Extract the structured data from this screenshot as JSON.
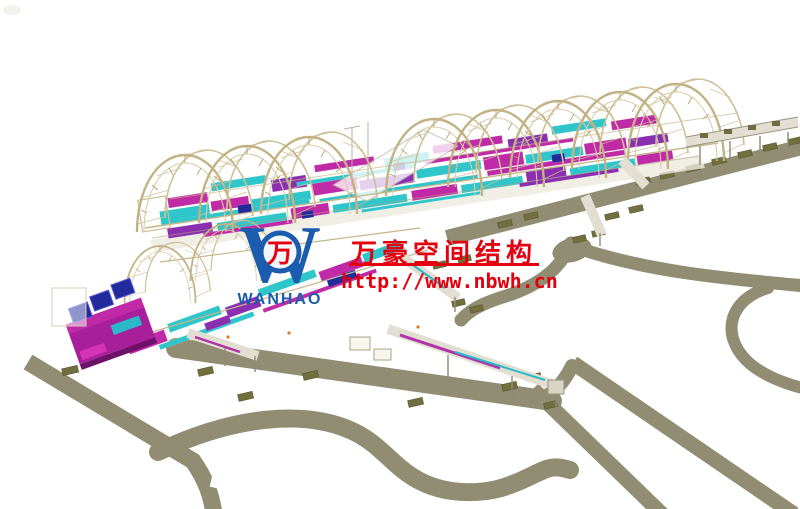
{
  "page": {
    "alt_text": "3D structural BIM model render of an airport terminal concourse with arched steel roof trusses, colored MEP duct systems, jet-bridge walkways, aprons and curving access roads, overlaid with a company watermark"
  },
  "watermark": {
    "company_name_cn": "万豪空间结构",
    "website_url": "http://www.nbwh.cn",
    "text_color": "#e3000f",
    "logo": {
      "word": "WANHAO",
      "glyph": "万",
      "blue": "#1b5caf",
      "glyph_color": "#e3000f"
    }
  },
  "palette": {
    "road": "#908d73",
    "pad": "#716f3e",
    "truss_tan": "#c2b284",
    "duct_cyan": "#2ec6cb",
    "duct_magenta": "#c02aa6",
    "duct_purple": "#8a2fb0",
    "equipment_blue": "#232a9c"
  }
}
